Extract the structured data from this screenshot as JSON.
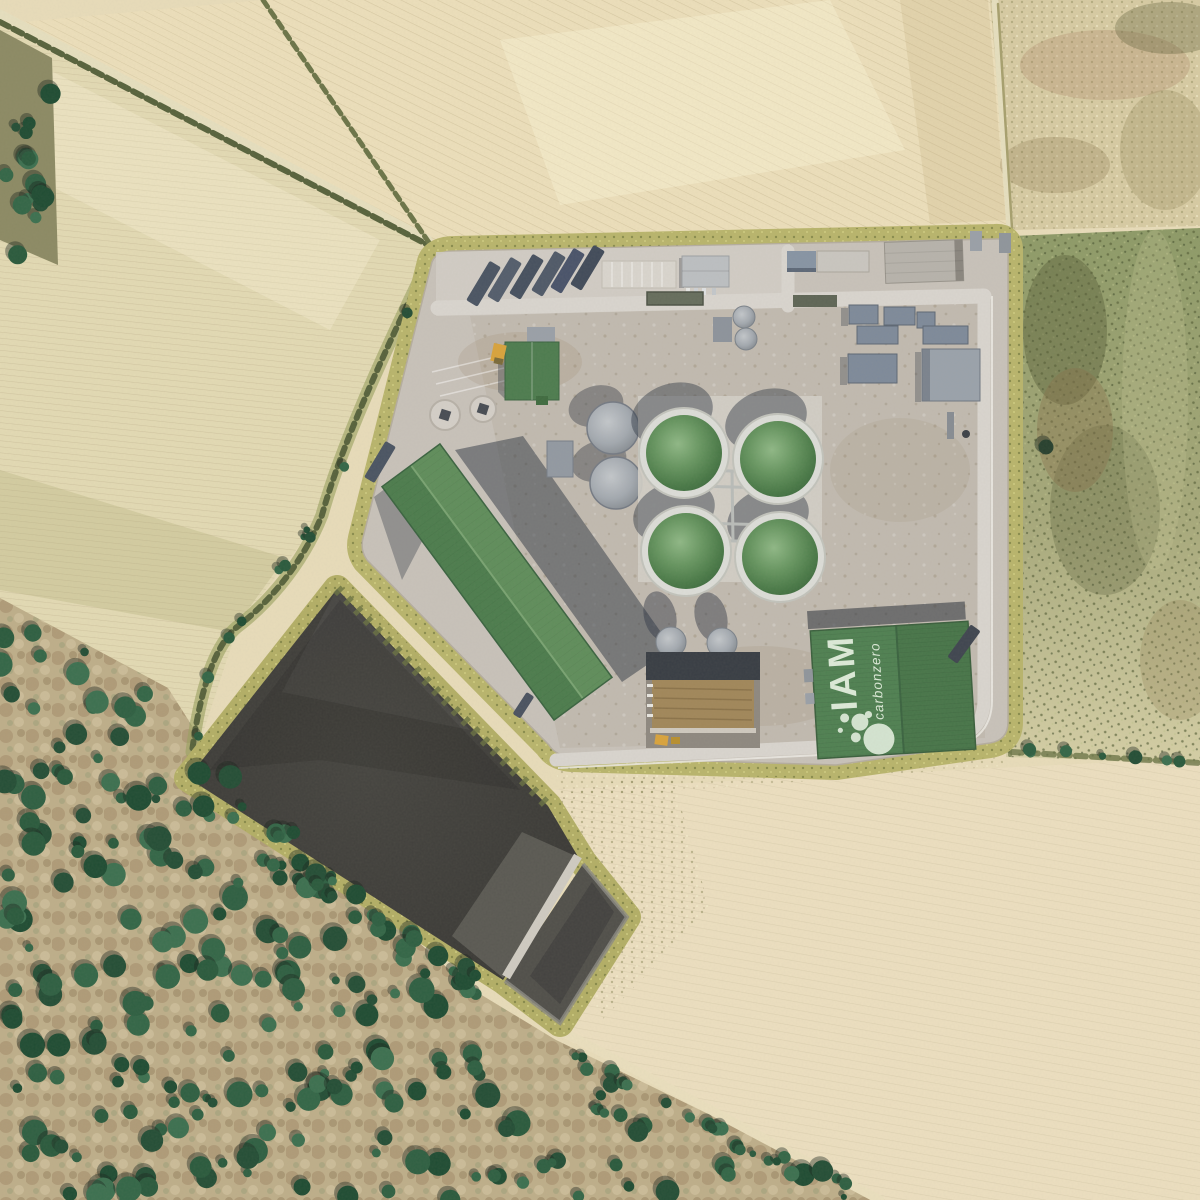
{
  "meta": {
    "title": "Aerial render of a biogas plant in farmland",
    "view": "top-down orthographic aerial photograph"
  },
  "branding": {
    "name": "IAM",
    "tagline": "carbonzero",
    "logo_icon": "bubbles-icon",
    "text_color": "#dcead8",
    "roof_color": "#4f8052"
  },
  "palette": {
    "pale_field": "#e9dfbc",
    "left_field": "#e3dab4",
    "topright_field": "#d7cba3",
    "green_field": "#93a06c",
    "verge": "#b9b56c",
    "hedge": "#57623c",
    "concrete": "#c8c2ba",
    "road": "#d9d5cf",
    "lagoon": "#3e3d38",
    "lagoon_cell": "#504f4a",
    "ramp": "#cfcbc2",
    "forest_ground": "#c9b38f",
    "tree_green": "#2a5a3d",
    "digester_dome": "#5f8b58",
    "long_roof": "#4c7c4d",
    "trailer": "#4a5463",
    "chp_unit": "#7e8a9a",
    "silage": "#a1875a",
    "loader_yellow": "#d9a33c",
    "shadow": "#2b3340"
  },
  "site": {
    "facility": "biogas-plant-platform",
    "digester_count": 4,
    "features": [
      "truck-trailer-parking",
      "weighbridge",
      "car-parking-grid",
      "office-building",
      "reception-building",
      "wheel-loader",
      "underground-tank-pads",
      "storage-tanks",
      "digester-tanks",
      "chp-units",
      "flare-stack",
      "silage-clamp",
      "long-storage-building",
      "iam-branded-warehouse",
      "digestate-lagoon",
      "lagoon-ramp",
      "farm-fields",
      "hedgerows",
      "oak-scrub-forest"
    ]
  }
}
